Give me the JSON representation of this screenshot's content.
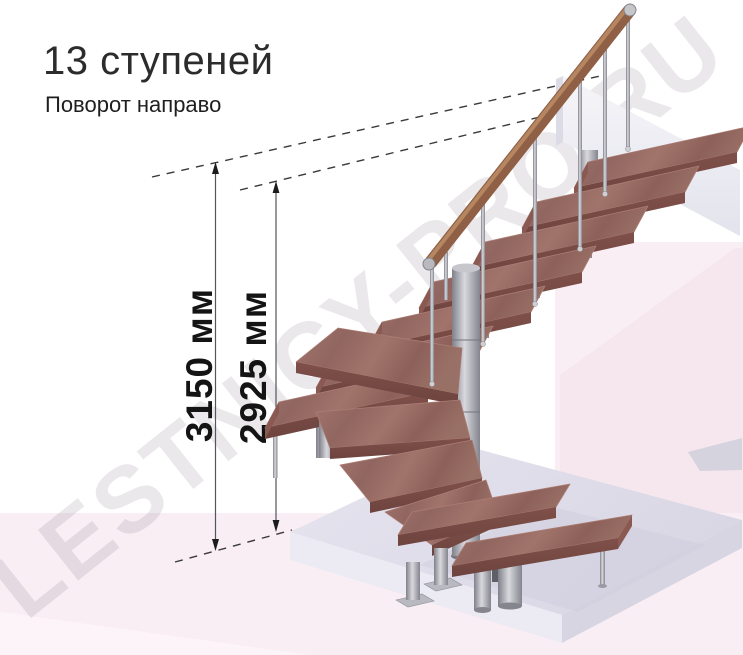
{
  "header": {
    "title": "13 ступеней",
    "subtitle": "Поворот направо"
  },
  "dimensions": {
    "total_height": {
      "label": "3150 мм"
    },
    "to_top_step": {
      "label": "2925 мм"
    }
  },
  "watermark": {
    "text": "LESTNICY-PRO.RU"
  },
  "diagram": {
    "type": "3d-staircase-render",
    "steps_total": 13,
    "turn_direction": "направо",
    "flights": {
      "upper_straight_steps": 7,
      "winder_steps": 4,
      "lower_straight_steps": 2
    },
    "colors": {
      "wood_top": "#9c7067",
      "wood_front": "#7a4b44",
      "handrail": "#8a5a41",
      "metal": "#9b9ba3",
      "platform_top": "#dfdde9",
      "platform_front": "#ebe9f2",
      "wall": "#f1f1f7",
      "background_pink": "#faeef5",
      "background_pink_dark": "#f6e7ef",
      "dimension_line": "#55555c",
      "dimension_text": "#141414",
      "watermark_gray": "rgba(90,78,96,0.13)"
    }
  }
}
